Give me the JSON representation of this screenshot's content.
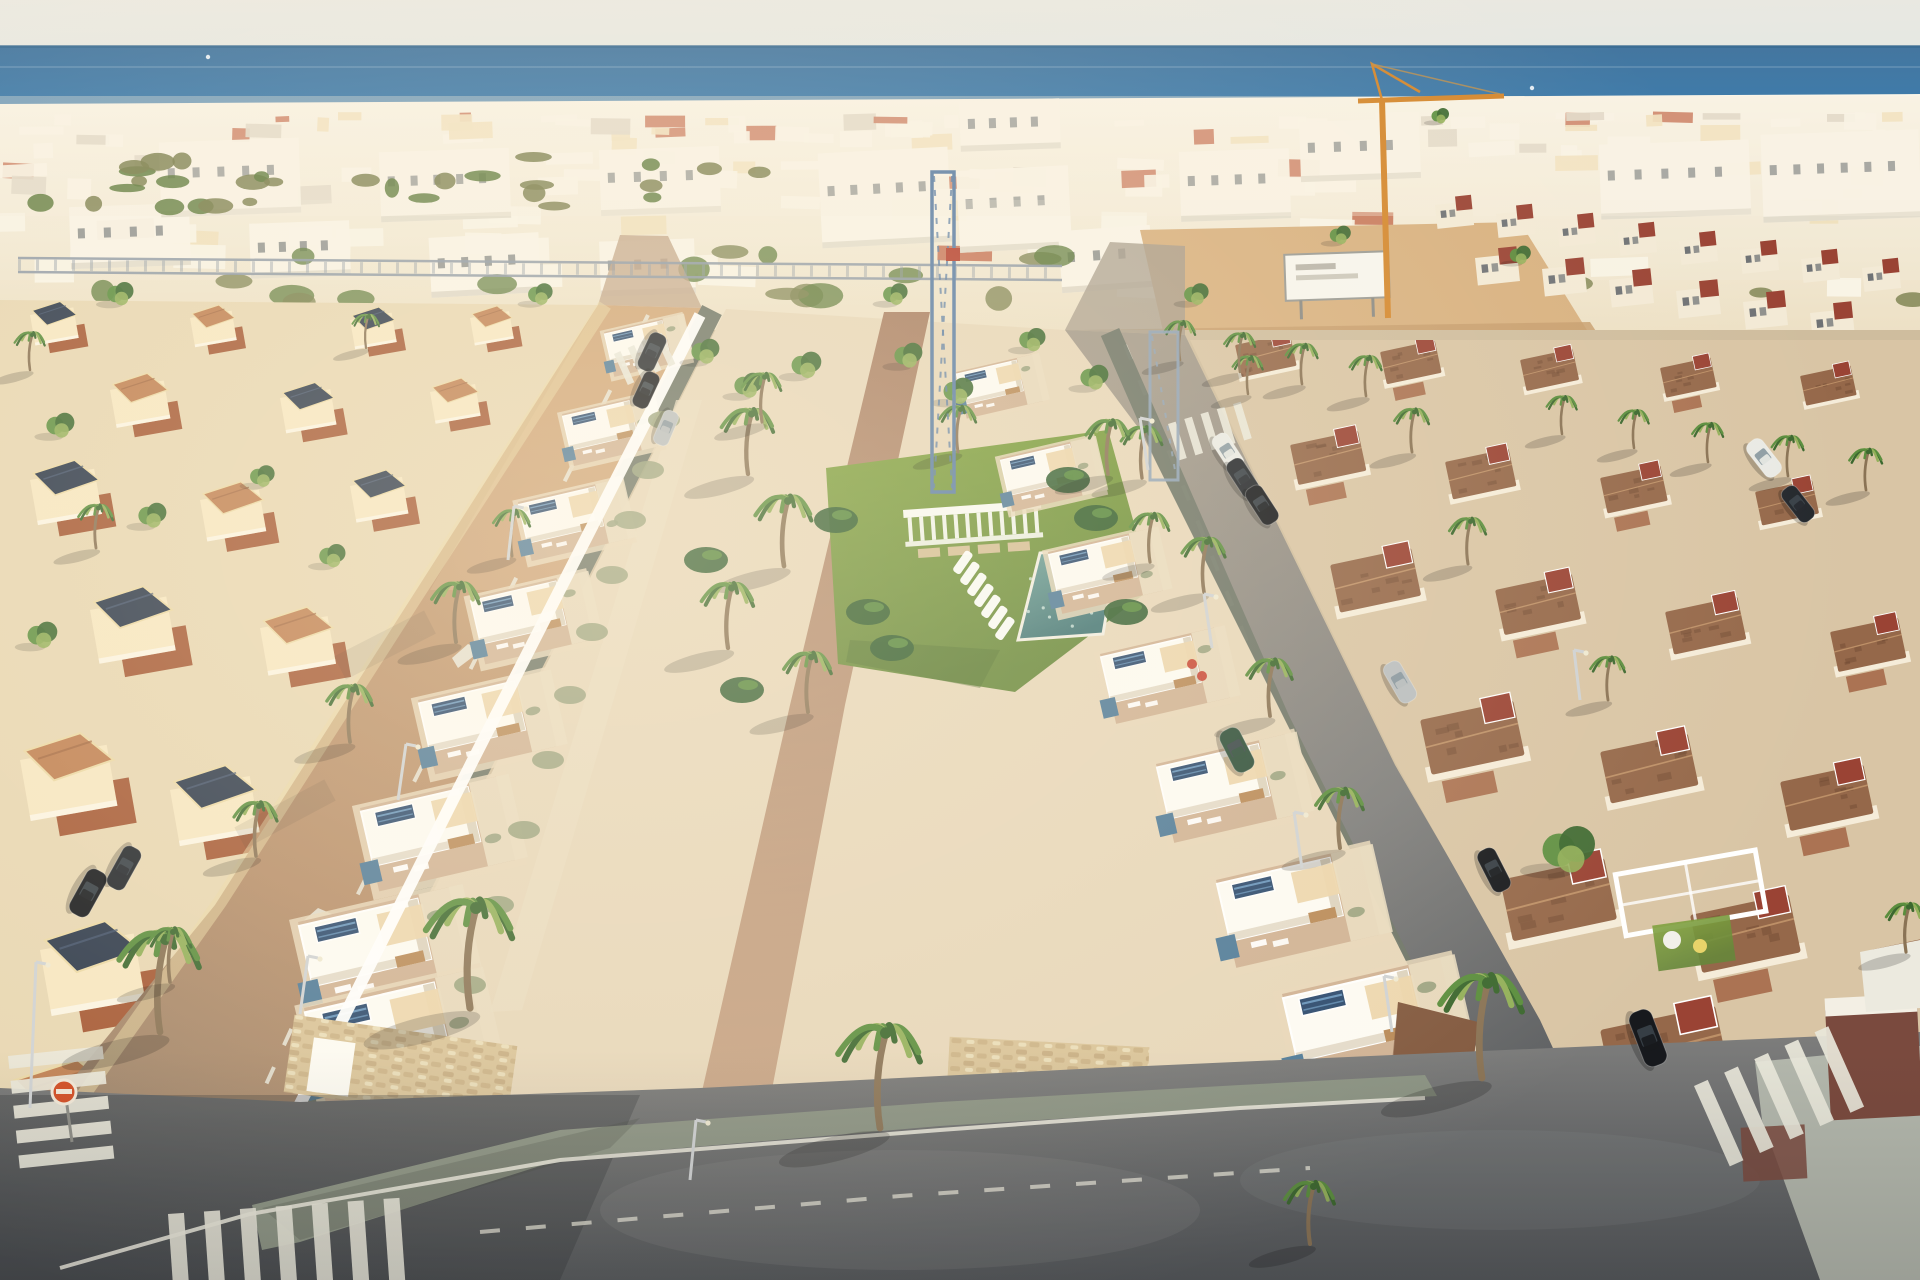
{
  "scene": {
    "palette": {
      "sky_top": "#ece9e0",
      "sky_bottom": "#dfe6e5",
      "sea_deep": "#44769f",
      "sea_mid": "#3f7cab",
      "sea_light": "#8db0c4",
      "horizon": "#38698f",
      "haze": "#f5eedd",
      "city_base": "#ecdfc3",
      "city_white": "#faf5e8",
      "city_cream": "#f0ddb4",
      "city_terracotta": "#bc5737",
      "city_gray": "#d9d0c0",
      "city_green": "#7b7f4e",
      "city_green_dark": "#5e7a3c",
      "ground": "#cfbd9e",
      "sand": "#d8b180",
      "sand_dark": "#c79e6d",
      "villa_wall": "#f7e7c2",
      "villa_terrace": "#a2532f",
      "villa_roof_dark": "#2e3a4c",
      "villa_roof_terra": "#c08052",
      "villa_trim": "#ecd9a6",
      "avenue_lit": "#c89b6e",
      "avenue_mid": "#b78e6a",
      "avenue_low": "#93816d",
      "road_light": "#a59b8c",
      "road_mid": "#7d7d7c",
      "road_dark": "#54575a",
      "sidewalk": "#8b9383",
      "sidewalk_dark": "#6e7567",
      "sidewalk_light": "#b3b7ac",
      "lane_mark": "#e9e7da",
      "dev_white": "#fdfbf4",
      "dev_shadow": "#ddd3bf",
      "dev_plot": "#e7d7ba",
      "dev_terrace": "#d0b294",
      "pergola": "#ecd5ab",
      "gravel": "#e9dcc0",
      "stone": "#d9c398",
      "stone_dark": "#b89a6e",
      "solar_dark": "#2c4a6e",
      "solar_light": "#6d9cc4",
      "accent_blue": "#507b99",
      "path_top": "#a97f63",
      "path_bottom": "#c9a687",
      "lawn": "#80a23e",
      "lawn_dark": "#66873a",
      "pool_light": "#6fa39b",
      "pool_dark": "#3f7374",
      "pool_edge": "#f1eee3",
      "palm_dark": "#3c682f",
      "palm_mid": "#5b8e3e",
      "palm_light": "#93b05a",
      "trunk": "#8a7355",
      "shrub": "#97a07c",
      "banana": "#2f5b2e",
      "flower_red": "#c43a2a",
      "roof_brown": "#95684a",
      "roof_brown_dark": "#6f4a33",
      "gable_red": "#9a4334",
      "villa_r_wall": "#f5ecd9",
      "patio": "#a5694a",
      "brick": "#7a4a3e",
      "crane_orange": "#d4882f",
      "crane_blue": "#5d7fa6",
      "truss": "#8f9aa6",
      "car_black": "#17191d",
      "car_dark": "#23272c",
      "car_white": "#e9eae5",
      "car_green": "#2e4f3a",
      "car_silver": "#b9bec0",
      "sign_red": "#d2491f",
      "white": "#ffffff"
    },
    "coastal": {
      "count": 150,
      "greens_far": 30,
      "greens_near": 26
    },
    "blocks": [
      [
        820,
        150,
        130,
        95,
        -3
      ],
      [
        958,
        168,
        112,
        82,
        -3
      ],
      [
        1060,
        228,
        92,
        62,
        -4
      ],
      [
        70,
        205,
        120,
        62,
        -2
      ],
      [
        250,
        222,
        100,
        55,
        -2
      ],
      [
        430,
        235,
        110,
        60,
        -3
      ],
      [
        600,
        240,
        95,
        55,
        -2
      ],
      [
        1180,
        150,
        110,
        70,
        -2
      ],
      [
        1600,
        142,
        150,
        75,
        -2
      ],
      [
        1762,
        132,
        158,
        88,
        -2
      ],
      [
        600,
        148,
        120,
        66,
        -2
      ],
      [
        380,
        150,
        130,
        70,
        -2
      ],
      [
        160,
        140,
        140,
        75,
        -2
      ],
      [
        960,
        100,
        100,
        50,
        -2
      ],
      [
        1300,
        120,
        120,
        60,
        -2
      ]
    ],
    "townhouses_row_a": [
      [
        1435,
        205
      ],
      [
        1496,
        214
      ],
      [
        1557,
        223
      ],
      [
        1618,
        232
      ],
      [
        1679,
        241
      ],
      [
        1740,
        250
      ],
      [
        1801,
        259
      ],
      [
        1862,
        268
      ]
    ],
    "townhouses_row_b": [
      [
        1475,
        258
      ],
      [
        1542,
        269
      ],
      [
        1609,
        280
      ],
      [
        1676,
        291
      ],
      [
        1743,
        302
      ],
      [
        1810,
        313
      ]
    ],
    "left_villas": [
      [
        30,
        315,
        0.5,
        1
      ],
      [
        190,
        318,
        0.48,
        0
      ],
      [
        350,
        320,
        0.48,
        1
      ],
      [
        470,
        318,
        0.45,
        0
      ],
      [
        110,
        390,
        0.62,
        0
      ],
      [
        280,
        398,
        0.58,
        1
      ],
      [
        430,
        392,
        0.52,
        0
      ],
      [
        30,
        480,
        0.74,
        1
      ],
      [
        200,
        500,
        0.68,
        0
      ],
      [
        350,
        486,
        0.6,
        1
      ],
      [
        90,
        610,
        0.88,
        1
      ],
      [
        260,
        628,
        0.78,
        0
      ],
      [
        20,
        760,
        1.0,
        0
      ],
      [
        170,
        790,
        0.92,
        1
      ],
      [
        40,
        950,
        1.08,
        1
      ],
      [
        10,
        1090,
        1.12,
        0
      ]
    ],
    "right_villas": [
      [
        1235,
        345,
        0.5,
        0
      ],
      [
        1380,
        352,
        0.5,
        1
      ],
      [
        1520,
        360,
        0.48,
        0
      ],
      [
        1660,
        368,
        0.46,
        1
      ],
      [
        1800,
        376,
        0.46,
        0
      ],
      [
        1290,
        445,
        0.62,
        1
      ],
      [
        1445,
        462,
        0.58,
        0
      ],
      [
        1600,
        478,
        0.55,
        1
      ],
      [
        1755,
        492,
        0.52,
        0
      ],
      [
        1330,
        565,
        0.74,
        0
      ],
      [
        1495,
        590,
        0.7,
        1
      ],
      [
        1665,
        612,
        0.66,
        0
      ],
      [
        1830,
        632,
        0.62,
        1
      ],
      [
        1420,
        720,
        0.85,
        1
      ],
      [
        1600,
        752,
        0.8,
        0
      ],
      [
        1780,
        782,
        0.76,
        1
      ],
      [
        1500,
        880,
        0.95,
        0
      ],
      [
        1690,
        915,
        0.9,
        1
      ],
      [
        1870,
        950,
        0.85,
        0
      ],
      [
        1600,
        1030,
        1.05,
        1
      ],
      [
        1800,
        1070,
        1.0,
        0
      ],
      [
        1560,
        1160,
        1.1,
        0
      ]
    ],
    "dev_left_units": [
      [
        604,
        332,
        0.5
      ],
      [
        562,
        414,
        0.58
      ],
      [
        518,
        502,
        0.66
      ],
      [
        470,
        598,
        0.74
      ],
      [
        418,
        700,
        0.83
      ],
      [
        360,
        808,
        0.93
      ],
      [
        298,
        922,
        1.03
      ],
      [
        304,
        1008,
        1.12
      ]
    ],
    "dev_right_units": [
      [
        956,
        372,
        0.52
      ],
      [
        1000,
        458,
        0.6
      ],
      [
        1048,
        552,
        0.69
      ],
      [
        1100,
        654,
        0.78
      ],
      [
        1156,
        764,
        0.88
      ],
      [
        1216,
        880,
        0.98
      ],
      [
        1282,
        994,
        1.08
      ]
    ],
    "palms": [
      [
        470,
        1008,
        2.0
      ],
      [
        880,
        1128,
        1.9
      ],
      [
        160,
        1032,
        1.85
      ],
      [
        1482,
        1078,
        1.9
      ],
      [
        456,
        642,
        1.1
      ],
      [
        350,
        742,
        1.05
      ],
      [
        256,
        856,
        1.0
      ],
      [
        170,
        982,
        1.0
      ],
      [
        512,
        556,
        0.85
      ],
      [
        1142,
        478,
        0.95
      ],
      [
        1204,
        592,
        1.0
      ],
      [
        1270,
        716,
        1.05
      ],
      [
        1340,
        848,
        1.1
      ],
      [
        1412,
        452,
        0.8
      ],
      [
        1468,
        564,
        0.85
      ],
      [
        1608,
        700,
        0.8
      ],
      [
        748,
        474,
        1.2
      ],
      [
        784,
        566,
        1.3
      ],
      [
        728,
        648,
        1.2
      ],
      [
        808,
        712,
        1.1
      ],
      [
        762,
        422,
        0.9
      ],
      [
        958,
        452,
        0.85
      ],
      [
        1108,
        474,
        1.0
      ],
      [
        1150,
        562,
        0.9
      ],
      [
        1562,
        434,
        0.7
      ],
      [
        1634,
        448,
        0.7
      ],
      [
        1708,
        462,
        0.72
      ],
      [
        1788,
        476,
        0.74
      ],
      [
        1866,
        490,
        0.76
      ],
      [
        1248,
        394,
        0.7
      ],
      [
        1906,
        952,
        0.9
      ],
      [
        1310,
        1244,
        1.15
      ],
      [
        96,
        548,
        0.8
      ],
      [
        30,
        370,
        0.7
      ],
      [
        366,
        348,
        0.62
      ],
      [
        1180,
        360,
        0.72
      ],
      [
        1240,
        372,
        0.72
      ],
      [
        1302,
        384,
        0.74
      ],
      [
        1366,
        396,
        0.74
      ]
    ],
    "trees": [
      [
        705,
        358,
        0.8
      ],
      [
        748,
        392,
        0.8
      ],
      [
        806,
        372,
        0.85
      ],
      [
        908,
        362,
        0.8
      ],
      [
        958,
        398,
        0.85
      ],
      [
        1032,
        346,
        0.75
      ],
      [
        1094,
        384,
        0.8
      ],
      [
        1568,
        862,
        1.5
      ],
      [
        60,
        432,
        0.8
      ],
      [
        152,
        522,
        0.8
      ],
      [
        42,
        642,
        0.85
      ],
      [
        332,
        562,
        0.75
      ],
      [
        262,
        482,
        0.7
      ],
      [
        1196,
        300,
        0.7
      ],
      [
        540,
        300,
        0.7
      ],
      [
        120,
        300,
        0.75
      ],
      [
        895,
        300,
        0.7
      ],
      [
        1440,
        120,
        0.5
      ],
      [
        1340,
        240,
        0.6
      ],
      [
        1520,
        260,
        0.6
      ]
    ],
    "shrubs": [
      [
        664,
        420
      ],
      [
        648,
        470
      ],
      [
        630,
        520
      ],
      [
        612,
        575
      ],
      [
        592,
        632
      ],
      [
        570,
        695
      ],
      [
        548,
        760
      ],
      [
        524,
        830
      ],
      [
        498,
        905
      ],
      [
        470,
        985
      ]
    ],
    "bananas": [
      [
        868,
        612
      ],
      [
        892,
        648
      ],
      [
        1068,
        480
      ],
      [
        1096,
        518
      ],
      [
        836,
        520
      ],
      [
        1126,
        612
      ],
      [
        706,
        560
      ],
      [
        742,
        690
      ]
    ],
    "flowers": [
      [
        1192,
        664
      ],
      [
        1202,
        676
      ]
    ],
    "cars": [
      [
        88,
        893,
        119,
        "car_black",
        50,
        22
      ],
      [
        124,
        868,
        119,
        "car_dark",
        46,
        20
      ],
      [
        652,
        352,
        115,
        "car_dark",
        40,
        18
      ],
      [
        646,
        390,
        115,
        "car_black",
        38,
        17
      ],
      [
        666,
        428,
        113,
        "car_silver",
        36,
        16
      ],
      [
        1228,
        452,
        57,
        "car_white",
        40,
        18
      ],
      [
        1243,
        478,
        57,
        "car_dark",
        42,
        19
      ],
      [
        1262,
        505,
        57,
        "car_black",
        42,
        19
      ],
      [
        1237,
        750,
        63,
        "car_green",
        46,
        22
      ],
      [
        1494,
        870,
        63,
        "car_black",
        46,
        20
      ],
      [
        1648,
        1038,
        69,
        "car_black",
        58,
        24
      ],
      [
        1400,
        682,
        60,
        "car_silver",
        44,
        19
      ],
      [
        1764,
        458,
        52,
        "car_white",
        42,
        19
      ],
      [
        1798,
        504,
        52,
        "car_dark",
        40,
        18
      ]
    ],
    "lamps": [
      [
        508,
        560,
        514,
        506
      ],
      [
        398,
        800,
        406,
        744
      ],
      [
        300,
        1014,
        308,
        956
      ],
      [
        30,
        1108,
        36,
        962
      ],
      [
        1148,
        470,
        1140,
        418
      ],
      [
        1212,
        648,
        1204,
        594
      ],
      [
        1302,
        868,
        1294,
        812
      ],
      [
        1392,
        1032,
        1384,
        976
      ],
      [
        690,
        1180,
        696,
        1120
      ],
      [
        1580,
        700,
        1574,
        650
      ]
    ],
    "crosswalks": [
      [
        8,
        1056,
        -6,
        5,
        95,
        13,
        12,
        0
      ],
      [
        168,
        1214,
        -4,
        7,
        85,
        16,
        20,
        1
      ],
      [
        1694,
        1086,
        -24,
        5,
        88,
        15,
        18,
        1
      ],
      [
        1168,
        424,
        -17,
        5,
        38,
        8,
        9,
        1
      ],
      [
        614,
        354,
        -24,
        4,
        34,
        7,
        8,
        1
      ]
    ],
    "loungers": {
      "x": 952,
      "y": 570,
      "n": 7,
      "dx": 7,
      "dy": 11,
      "rot": -55,
      "w": 25,
      "h": 9
    },
    "boats": [
      [
        208,
        57
      ],
      [
        1532,
        88
      ]
    ]
  }
}
